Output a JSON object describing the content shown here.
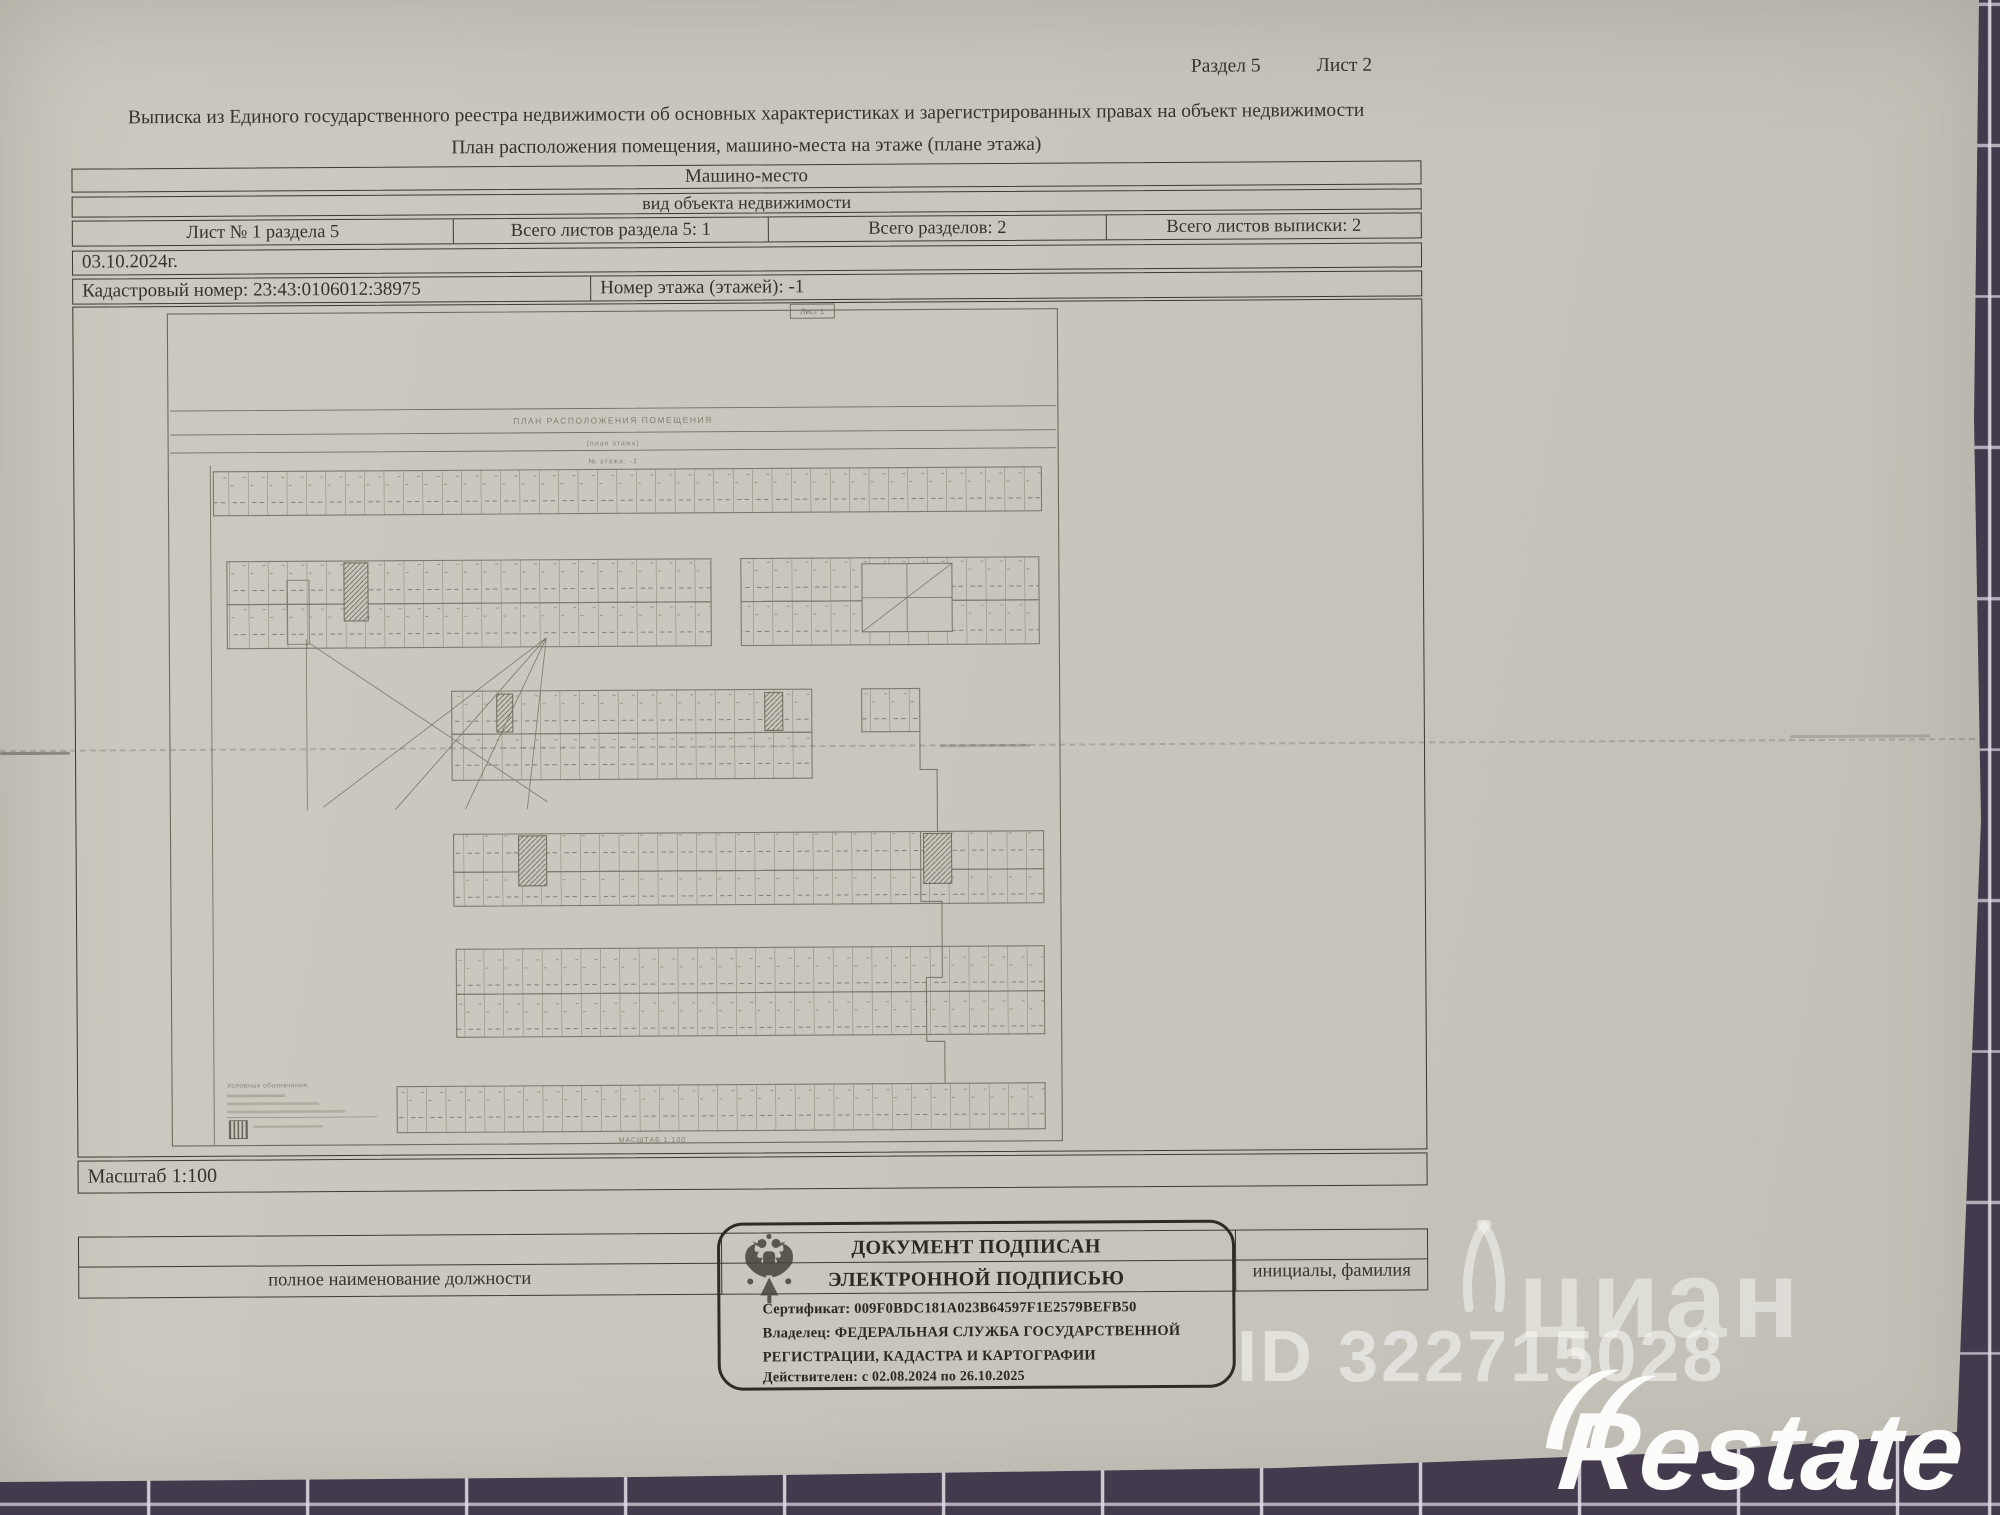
{
  "page": {
    "section_label": "Раздел 5",
    "sheet_label": "Лист 2"
  },
  "title": "Выписка из Единого государственного реестра недвижимости об основных характеристиках и зарегистрированных правах на объект недвижимости",
  "subtitle": "План расположения помещения, машино-места на этаже (плане этажа)",
  "object_table": {
    "object_type": "Машино-место",
    "object_type_caption": "вид объекта недвижимости",
    "sheet_info": "Лист № 1 раздела 5",
    "sheets_in_section": "Всего листов раздела 5: 1",
    "total_sections": "Всего разделов: 2",
    "total_sheets": "Всего листов выписки: 2",
    "date": "03.10.2024г.",
    "cadastral_number": "Кадастровый номер: 23:43:0106012:38975",
    "floor_number": "Номер этажа (этажей): -1",
    "scale": "Масштаб 1:100"
  },
  "plan": {
    "header_title": "ПЛАН РАСПОЛОЖЕНИЯ ПОМЕЩЕНИЯ",
    "header_sub1": "(план этажа)",
    "header_sub2": "№ этажа: -1",
    "sheet_stamp": "Лист 1",
    "legend_title": "Условные обозначения:",
    "scale_note": "МАСШТАБ 1:100"
  },
  "signature_block": {
    "position_caption": "полное наименование должности",
    "name_caption": "инициалы, фамилия",
    "stamp": {
      "line1": "ДОКУМЕНТ ПОДПИСАН",
      "line2": "ЭЛЕКТРОННОЙ ПОДПИСЬЮ",
      "certificate": "Сертификат: 009F0BDC181A023B64597F1E2579BEFB50",
      "owner_line1": "Владелец: ФЕДЕРАЛЬНАЯ СЛУЖБА ГОСУДАРСТВЕННОЙ",
      "owner_line2": "РЕГИСТРАЦИИ, КАДАСТРА И КАРТОГРАФИИ",
      "validity": "Действителен: с 02.08.2024 по 26.10.2025"
    }
  },
  "watermarks": {
    "cian": "циан",
    "cian_id": "ID 322715028",
    "restate": "Restate"
  },
  "colors": {
    "paper": "#c9c6bd",
    "ink": "#37342e",
    "tile": "#443a4d",
    "grout": "#ded9e3",
    "plan_line": "#7e796d",
    "logo_white": "#fcfcfa"
  }
}
